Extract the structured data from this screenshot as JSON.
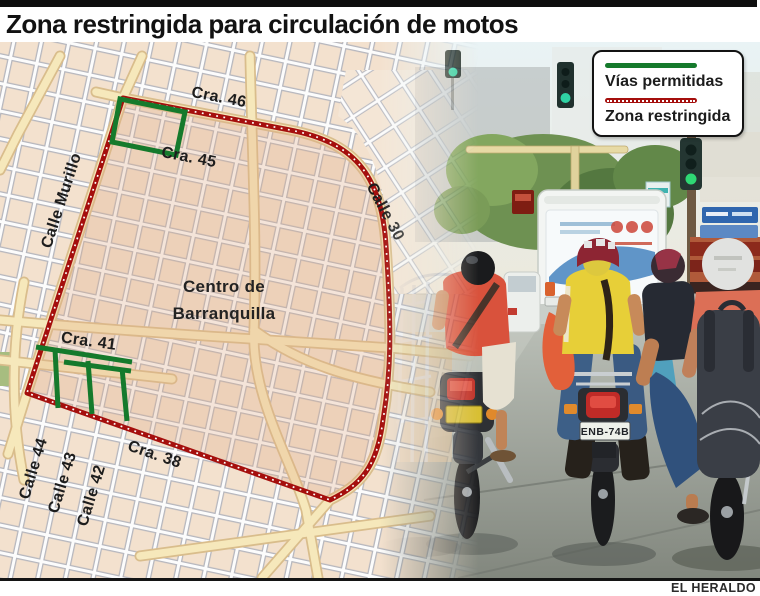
{
  "header": {
    "title": "Zona restringida para circulación de motos"
  },
  "legend": {
    "permitted_label": "Vías permitidas",
    "restricted_label": "Zona restringida"
  },
  "map": {
    "labels": {
      "cra46": "Cra. 46",
      "cra45": "Cra. 45",
      "calle_murillo": "Calle Murillo",
      "calle30": "Calle 30",
      "centro_line1": "Centro de",
      "centro_line2": "Barranquilla",
      "cra41": "Cra. 41",
      "calle44": "Calle 44",
      "calle43": "Calle 43",
      "calle42": "Calle 42",
      "cra38": "Cra. 38"
    }
  },
  "photo": {
    "plate_center": "ENB-74B",
    "plate_right": "GTQ-"
  },
  "footer": {
    "credit": "EL HERALDO"
  },
  "colors": {
    "permitted_green": "#157a2c",
    "restricted_red": "#a50f0d",
    "map_background": "#f3e1ce",
    "road_yellow": "#f6e8bb"
  }
}
